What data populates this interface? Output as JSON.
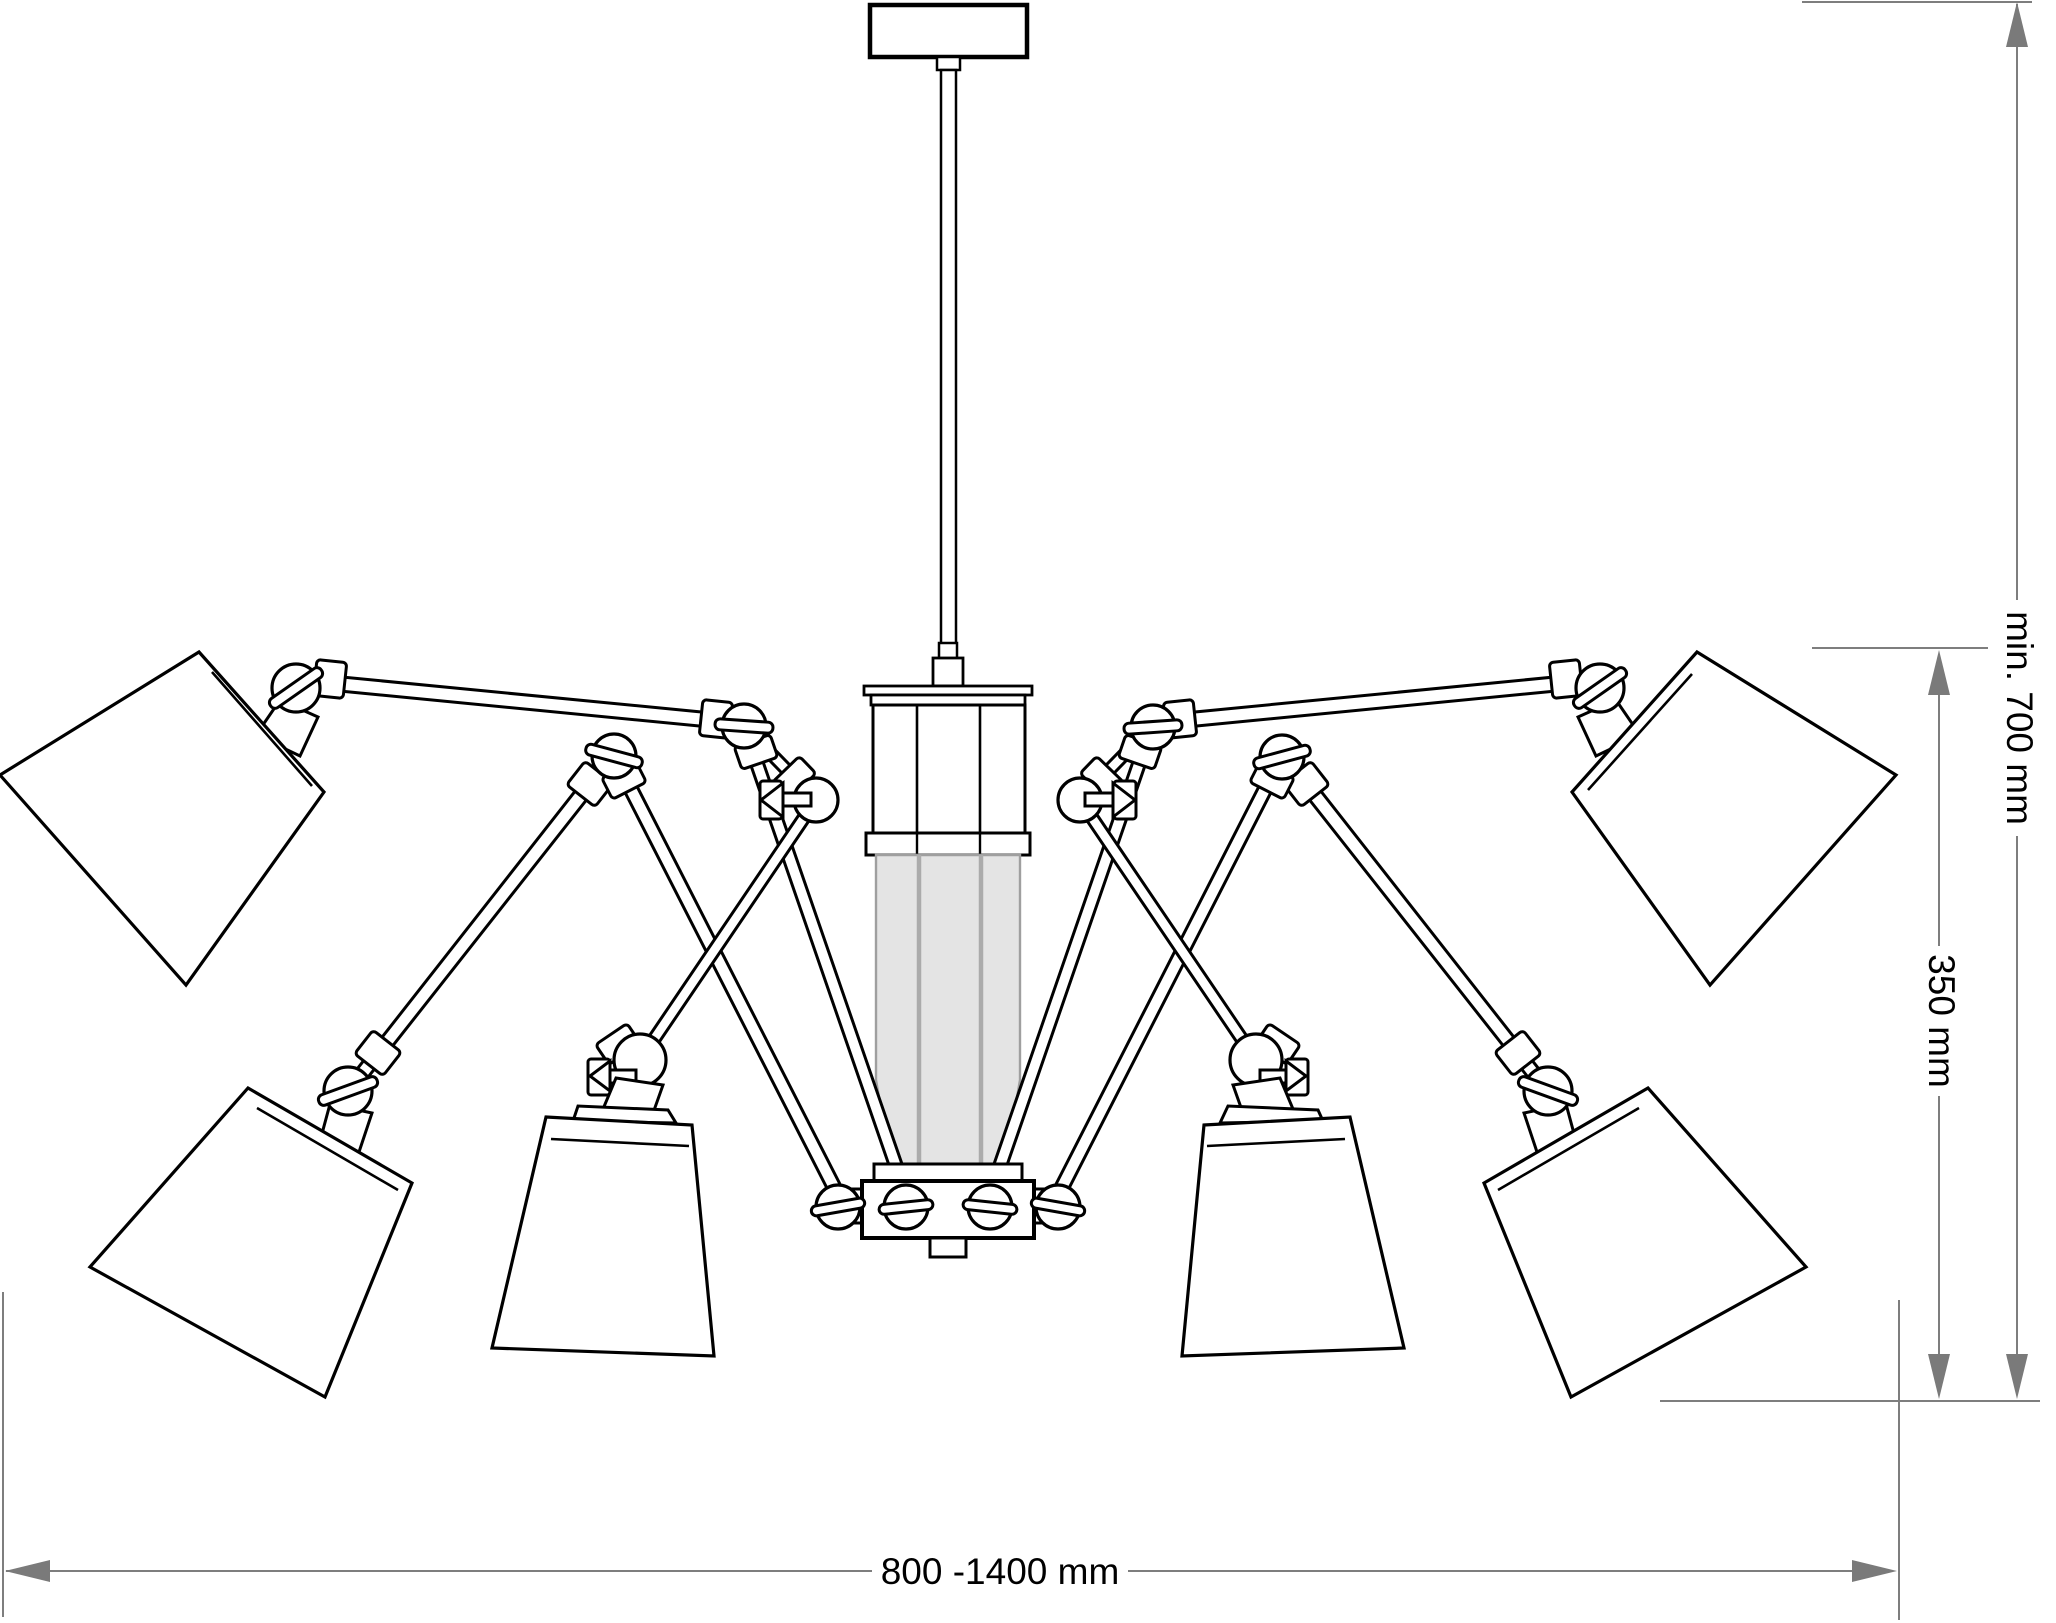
{
  "drawing": {
    "description": "Technical elevation drawing of a multi-arm chandelier with articulated arms, cone shades and cylindrical glass diffuser"
  },
  "colors": {
    "outline": "#000000",
    "fill": "#ffffff",
    "glass_fill": "#e4e4e4",
    "glass_divider": "#ababab",
    "glass_edge": "#9f9f9f",
    "dimension_line": "#7e7e7e",
    "dimension_arrow": "#7a7a7a",
    "background": "#ffffff"
  },
  "dimensions": {
    "overall_height": {
      "label": "min. 700 mm"
    },
    "body_height": {
      "label": "350 mm"
    },
    "overall_width": {
      "label": "800 -1400 mm"
    }
  }
}
